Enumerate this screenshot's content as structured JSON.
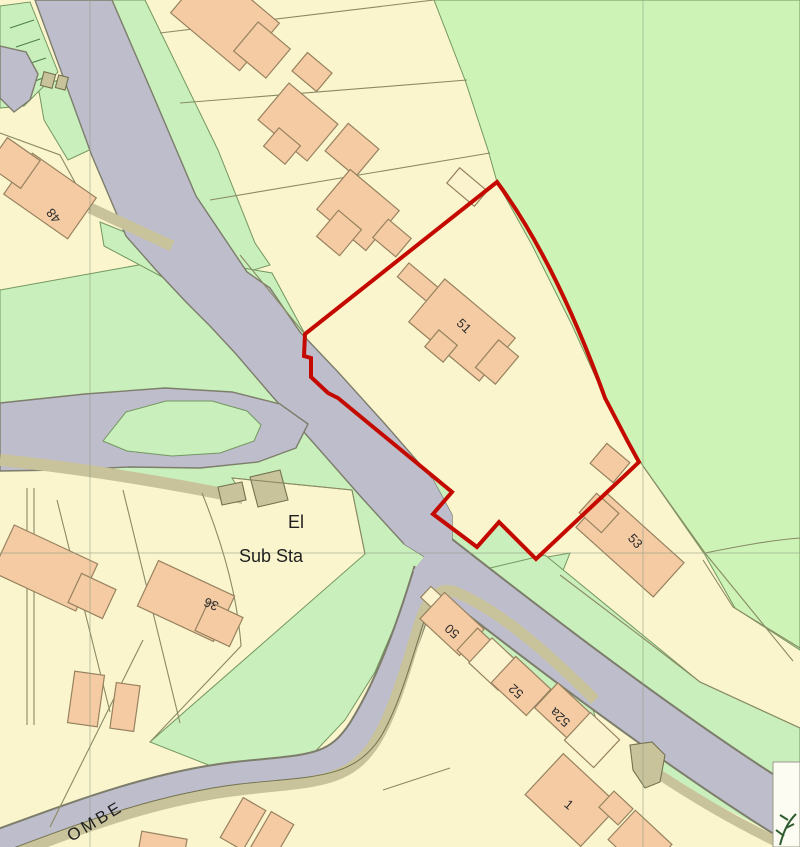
{
  "map": {
    "house_numbers": {
      "h48": "48",
      "h50": "50",
      "h51": "51",
      "h52": "52",
      "h52a": "52a",
      "h53": "53",
      "h36": "36",
      "h1": "1"
    },
    "labels": {
      "substation_line1": "El",
      "substation_line2": "Sub Sta",
      "street_name_fragment": "OMBE"
    },
    "boundary": {
      "color": "#c40a00"
    },
    "colors": {
      "parcel_cream": "#fbf5cd",
      "grass_green": "#c9efbc",
      "field_green": "#cdf3b7",
      "road_gray": "#bebdcb",
      "road_casing": "#7d7d6b",
      "verge_khaki": "#c9c39b",
      "building_fill": "#f4cba3",
      "building_outline": "#97825f",
      "outbuilding_fill": "#faf3cd",
      "parcel_line": "#8a8a64",
      "grid_line": "#8c9c84",
      "label_text": "#2d2d2d",
      "legend_panel": "#fcfcf2"
    }
  }
}
